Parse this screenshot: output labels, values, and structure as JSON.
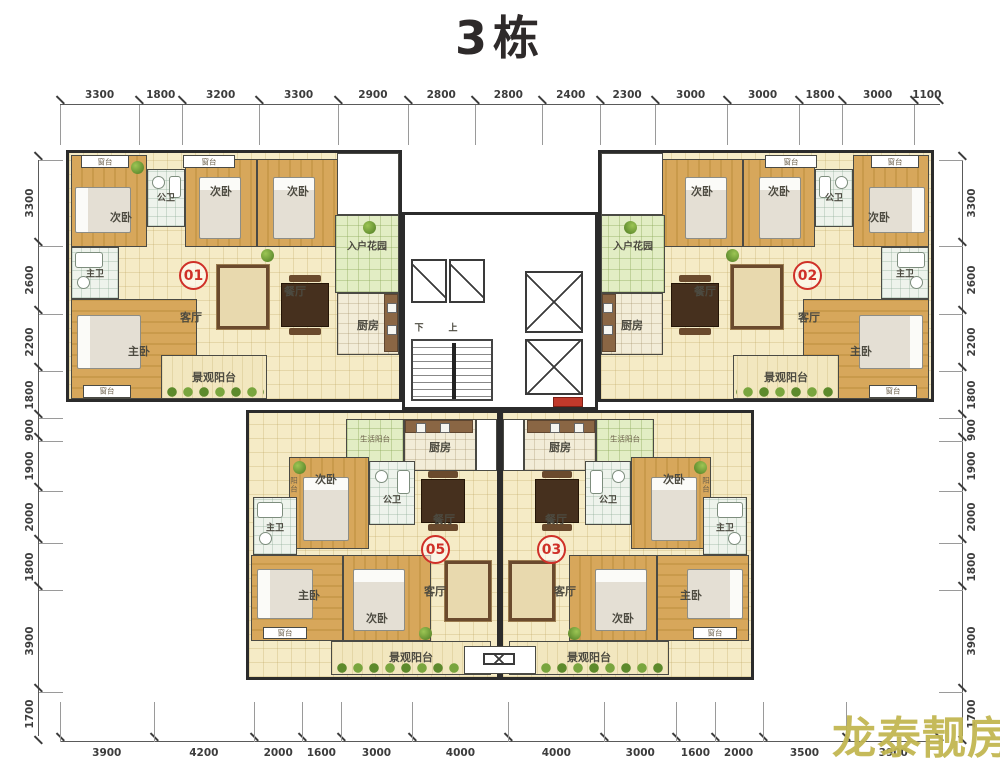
{
  "title": "3栋",
  "watermark": "龙泰靓房",
  "units": {
    "u01": "01",
    "u02": "02",
    "u05": "05",
    "u03": "03"
  },
  "rooms": {
    "secondary_bedroom": "次卧",
    "master_bedroom": "主卧",
    "living_room": "客厅",
    "dining_room": "餐厅",
    "kitchen": "厨房",
    "public_bath": "公卫",
    "master_bath": "主卫",
    "entry_garden": "入户花园",
    "view_balcony": "景观阳台",
    "utility_balcony": "生活阳台",
    "window_sill": "窗台",
    "balcony": "阳台"
  },
  "stairs": {
    "down": "下",
    "up": "上"
  },
  "dimensions": {
    "top": [
      3300,
      1800,
      3200,
      3300,
      2900,
      2800,
      2800,
      2400,
      2300,
      3000,
      3000,
      1800,
      3000,
      1100
    ],
    "bottom": [
      3900,
      4200,
      2000,
      1600,
      3000,
      4000,
      4000,
      3000,
      1600,
      2000,
      3500,
      3900
    ],
    "left": [
      3300,
      2600,
      2200,
      1800,
      900,
      1900,
      2000,
      1800,
      3900,
      1700
    ],
    "right": [
      3300,
      2600,
      2200,
      1800,
      900,
      1900,
      2000,
      1800,
      3900,
      1700
    ]
  },
  "colors": {
    "wood": "#d2a457",
    "tile_cream": "#f5ebc6",
    "garden_green": "#e2edc4",
    "bath_tile": "#eef3ec",
    "wall": "#2b2b2b",
    "unit_red": "#cf3028",
    "watermark": "#c2b752"
  }
}
